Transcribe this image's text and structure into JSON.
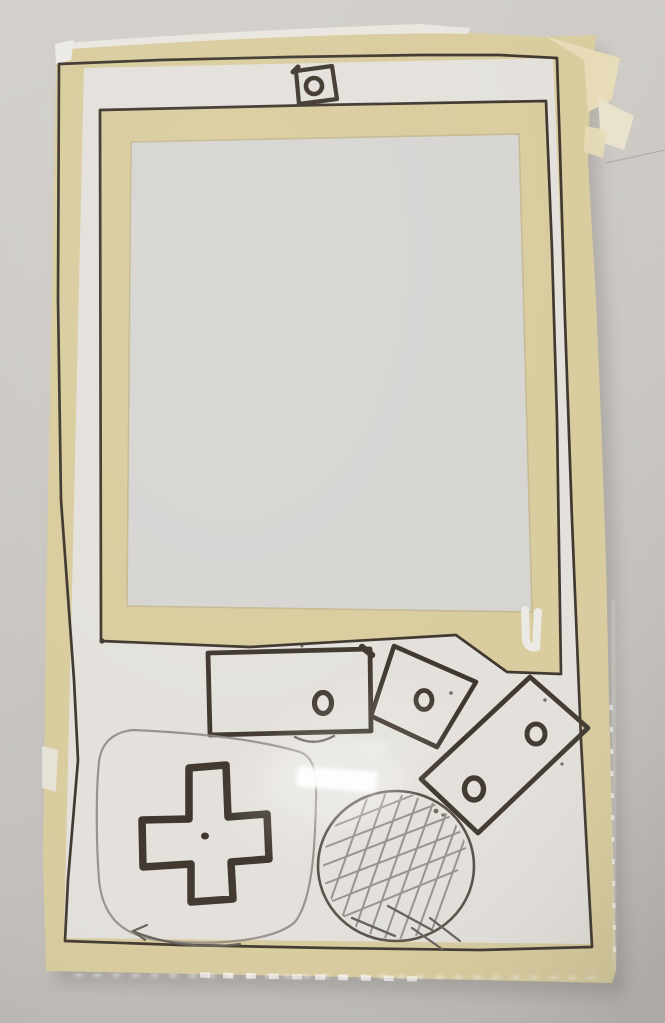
{
  "scene": {
    "description": "Photograph of a handmade prototype of a handheld game console: white paper and beige masking tape mounted on a clear acrylic sheet, hand-drawn controls in black marker and pencil, hung on a plain gray wall with a camera-flash glare on the plastic",
    "setting": "plain gray wall, indoor flash lighting",
    "object": "hand-drawn handheld game console mockup (Game Boy style)"
  },
  "palette": {
    "wall": "#cac7c3",
    "wall_light": "#d3d0cb",
    "wall_dark": "#bfbcb8",
    "tape": "#d9cc9e",
    "tape_light": "#e7dcb7",
    "tape_dark": "#cdbf8d",
    "paper": "#e4e1dc",
    "paper_bright": "#edebe6",
    "screen": "#d7d5d2",
    "ink": "#40382f",
    "pencil": "#8f8983",
    "pencil_dark": "#665f59",
    "glare": "#ffffff",
    "shadow": "#6a6661"
  },
  "parts": [
    {
      "id": "masking-tape-frame",
      "label": "outer masking-tape border with hand-inked outline"
    },
    {
      "id": "paper-faceplate",
      "label": "white paper face of the device"
    },
    {
      "id": "screen-window",
      "label": "large screen cutout framed with masking tape and ink"
    },
    {
      "id": "camera-cutout",
      "label": "small inked square with circle, top center"
    },
    {
      "id": "start-button-bar",
      "label": "inked rectangle with one small circle"
    },
    {
      "id": "action-button-square",
      "label": "tilted inked square with one circle"
    },
    {
      "id": "action-button-pair",
      "label": "tilted inked rectangle with two circles"
    },
    {
      "id": "d-pad",
      "label": "thick inked cross with center dot"
    },
    {
      "id": "d-pad-sketch-outline",
      "label": "light pencil rounded outline around the d-pad"
    },
    {
      "id": "speaker-grille-sketch",
      "label": "pencil circle filled with crosshatching"
    },
    {
      "id": "flash-glare",
      "label": "bright camera-flash reflection on the acrylic"
    },
    {
      "id": "acrylic-edge",
      "label": "glinting clear plastic edges at right and bottom"
    }
  ]
}
